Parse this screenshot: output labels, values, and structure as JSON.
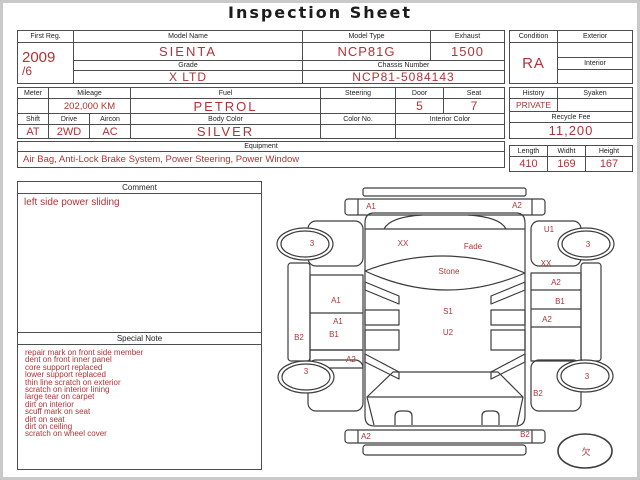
{
  "title": "Inspection Sheet",
  "colors": {
    "accent": "#b03336",
    "line": "#4d4d4d"
  },
  "info": {
    "first_reg": {
      "label": "First Reg.",
      "value_line1": "2009",
      "value_line2": "/6"
    },
    "model_name": {
      "label": "Model Name",
      "value": "SIENTA"
    },
    "grade": {
      "label": "Grade",
      "value": "X LTD"
    },
    "model_type": {
      "label": "Model Type",
      "value": "NCP81G"
    },
    "exhaust": {
      "label": "Exhaust",
      "value": "1500"
    },
    "chassis_number": {
      "label": "Chassis Number",
      "value": "NCP81-5084143"
    },
    "condition": {
      "label": "Condition",
      "value": "RA"
    },
    "exterior": {
      "label": "Exterior",
      "value": ""
    },
    "interior": {
      "label": "Interior",
      "value": ""
    },
    "meter": {
      "label": "Meter",
      "value": ""
    },
    "mileage": {
      "label": "Mileage",
      "value": "202,000 KM"
    },
    "fuel": {
      "label": "Fuel",
      "value": "PETROL"
    },
    "steering": {
      "label": "Steering",
      "value": ""
    },
    "door": {
      "label": "Door",
      "value": "5"
    },
    "seat": {
      "label": "Seat",
      "value": "7"
    },
    "shift": {
      "label": "Shift",
      "value": "AT"
    },
    "drive": {
      "label": "Drive",
      "value": "2WD"
    },
    "aircon": {
      "label": "Aircon",
      "value": "AC"
    },
    "body_color": {
      "label": "Body Color",
      "value": "SILVER"
    },
    "color_no": {
      "label": "Color No.",
      "value": ""
    },
    "interior_color": {
      "label": "Interior Color",
      "value": ""
    },
    "history": {
      "label": "History",
      "value": "PRIVATE"
    },
    "syaken": {
      "label": "Syaken",
      "value": ""
    },
    "recycle_fee": {
      "label": "Recycle Fee",
      "value": "11,200"
    },
    "equipment": {
      "label": "Equipment",
      "value": "Air Bag, Anti-Lock Brake System, Power Steering, Power Window"
    },
    "length": {
      "label": "Length",
      "value": "410"
    },
    "width": {
      "label": "Widht",
      "value": "169"
    },
    "height": {
      "label": "Height",
      "value": "167"
    }
  },
  "comment": {
    "label": "Comment",
    "lines": [
      "left side power sliding"
    ]
  },
  "special_note": {
    "label": "Special Note",
    "lines": [
      "repair mark on front side member",
      "dent on front inner panel",
      "core support replaced",
      "lower support replaced",
      "thin line scratch on exterior",
      "scratch on interior lining",
      "large tear on carpet",
      "dirt on interior",
      "scuff mark on seat",
      "dirt on seat",
      "dirt on ceiling",
      "scratch on wheel cover"
    ]
  },
  "diagram": {
    "labels": [
      {
        "t": "A1",
        "x": 103,
        "y": 31
      },
      {
        "t": "A2",
        "x": 249,
        "y": 30
      },
      {
        "t": "3",
        "x": 44,
        "y": 68
      },
      {
        "t": "XX",
        "x": 135,
        "y": 68
      },
      {
        "t": "Fade",
        "x": 205,
        "y": 71
      },
      {
        "t": "U1",
        "x": 281,
        "y": 54
      },
      {
        "t": "3",
        "x": 320,
        "y": 69
      },
      {
        "t": "Stone",
        "x": 181,
        "y": 96
      },
      {
        "t": "XX",
        "x": 278,
        "y": 88
      },
      {
        "t": "A2",
        "x": 288,
        "y": 107
      },
      {
        "t": "A1",
        "x": 68,
        "y": 125
      },
      {
        "t": "B1",
        "x": 292,
        "y": 126
      },
      {
        "t": "S1",
        "x": 180,
        "y": 136
      },
      {
        "t": "A1",
        "x": 70,
        "y": 146
      },
      {
        "t": "A2",
        "x": 279,
        "y": 144
      },
      {
        "t": "B2",
        "x": 31,
        "y": 162
      },
      {
        "t": "B1",
        "x": 66,
        "y": 159
      },
      {
        "t": "U2",
        "x": 180,
        "y": 157
      },
      {
        "t": "A2",
        "x": 83,
        "y": 184
      },
      {
        "t": "3",
        "x": 38,
        "y": 196
      },
      {
        "t": "B2",
        "x": 270,
        "y": 218
      },
      {
        "t": "3",
        "x": 319,
        "y": 201
      },
      {
        "t": "A2",
        "x": 98,
        "y": 261
      },
      {
        "t": "B2",
        "x": 257,
        "y": 259
      },
      {
        "t": "欠",
        "x": 318,
        "y": 277,
        "s": 9
      }
    ]
  }
}
